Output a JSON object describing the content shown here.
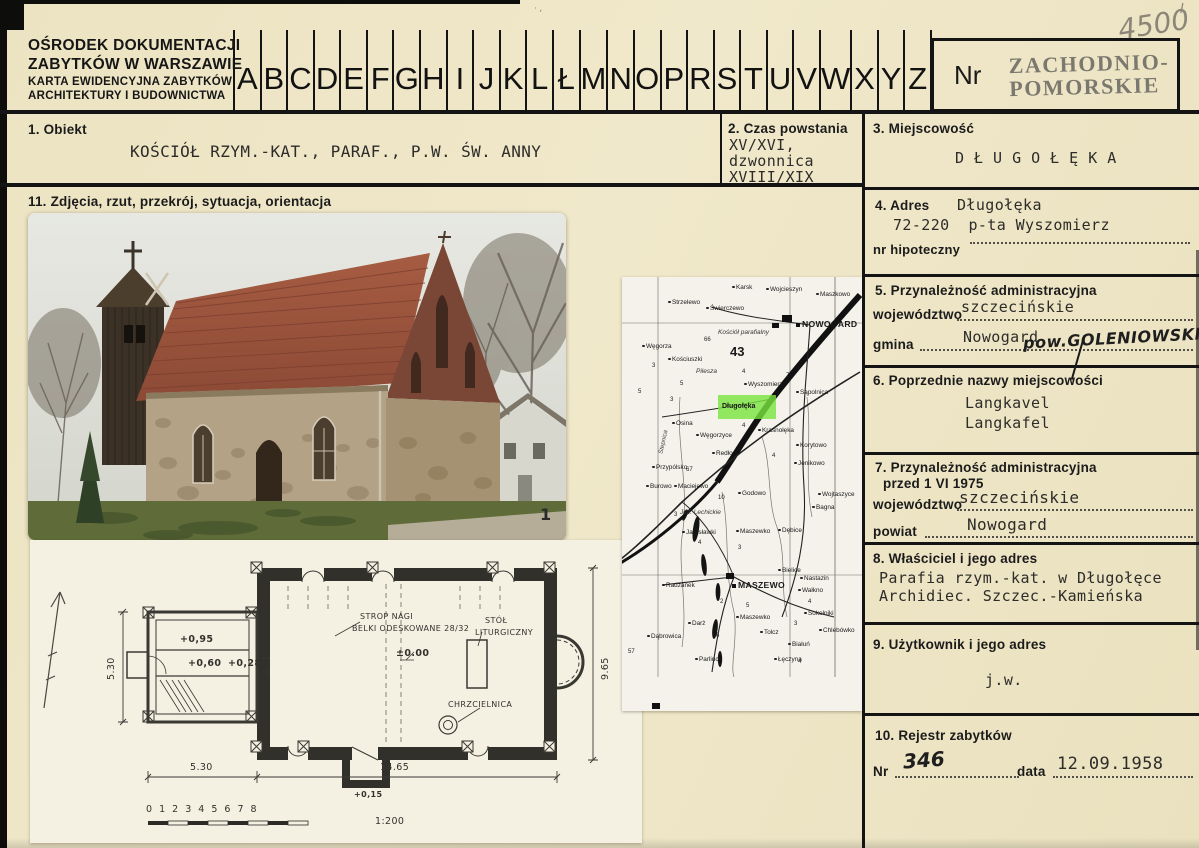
{
  "header": {
    "org_lines": [
      "OŚRODEK DOKUMENTACJI",
      "ZABYTKÓW W WARSZAWIE",
      "KARTA EWIDENCYJNA ZABYTKÓW",
      "ARCHITEKTURY I BUDOWNICTWA"
    ],
    "alphabet": [
      "A",
      "B",
      "C",
      "D",
      "E",
      "F",
      "G",
      "H",
      "I",
      "J",
      "K",
      "L",
      "Ł",
      "M",
      "N",
      "O",
      "P",
      "R",
      "S",
      "T",
      "U",
      "V",
      "W",
      "X",
      "Y",
      "Z"
    ],
    "nr_label": "Nr",
    "stamp_line1": "ZACHODNIO-",
    "stamp_line2": "POMORSKIE",
    "handwritten_number": "4500",
    "handwritten_mark": "I."
  },
  "fields": {
    "f1": {
      "label": "1. Obiekt",
      "value": "KOŚCIÓŁ RZYM.-KAT., PARAF., P.W. ŚW. ANNY"
    },
    "f2": {
      "label": "2. Czas powstania",
      "line1": "XV/XVI,",
      "line2": "dzwonnica",
      "line3": "XVIII/XIX"
    },
    "f3": {
      "label": "3. Miejscowość",
      "value": "DŁUGOŁĘKA"
    },
    "f4": {
      "label": "4. Adres",
      "line1": "Długołęka",
      "line2": "72-220  p-ta Wyszomierz",
      "sub_label": "nr hipoteczny"
    },
    "f5": {
      "label": "5. Przynależność administracyjna",
      "row1_label": "województwo",
      "row1_value": "szczecińskie",
      "row2_label": "gmina",
      "row2_value": "Nowogard",
      "row2_handwritten": "pow.GOLENIOWSKI"
    },
    "f6": {
      "label": "6. Poprzednie nazwy miejscowości",
      "line1": "Langkavel",
      "line2": "Langkafel"
    },
    "f7": {
      "label": "7. Przynależność administracyjna",
      "label2": "przed 1 VI 1975",
      "row1_label": "województwo",
      "row1_value": "szczecińskie",
      "row2_label": "powiat",
      "row2_value": "Nowogard"
    },
    "f8": {
      "label": "8. Właściciel i jego adres",
      "line1": "Parafia rzym.-kat. w Długołęce",
      "line2": "Archidiec. Szczec.-Kamieńska"
    },
    "f9": {
      "label": "9. Użytkownik i jego adres",
      "value": "j.w."
    },
    "f10": {
      "label": "10. Rejestr zabytków",
      "nr_label": "Nr",
      "nr_value": "346",
      "date_label": "data",
      "date_value": "12.09.1958"
    },
    "f11": {
      "label": "11. Zdjęcia, rzut, przekrój, sytuacja, orientacja"
    }
  },
  "photo": {
    "mark": "1"
  },
  "plan": {
    "dim_left": "5.30",
    "level_top": "+0,95",
    "level_mid": "+0,60",
    "level_low": "+0,28",
    "strop_line1": "STROP NAGI",
    "strop_line2": "BELKI ODESKOWANE 28/32",
    "zero_level": "±0.00",
    "stol_line1": "STÓŁ",
    "stol_line2": "LITURGICZNY",
    "chrzcielnica": "CHRZCIELNICA",
    "level_porch": "+0,15",
    "dim_bottom_left": "5.30",
    "dim_bottom_right": "14.65",
    "dim_right": "9.65",
    "scale_numbers": "0   1   2   3   4   5   6   7   8",
    "scale_ratio": "1:200"
  },
  "map": {
    "highlight_name": "Długołęka",
    "labels": [
      {
        "t": "Karsk",
        "x": 110,
        "y": 8,
        "k": "s"
      },
      {
        "t": "Wojcieszyn",
        "x": 144,
        "y": 10,
        "k": "s"
      },
      {
        "t": "Maszkowo",
        "x": 194,
        "y": 15,
        "k": "s"
      },
      {
        "t": "Strzelewo",
        "x": 46,
        "y": 23,
        "k": "s"
      },
      {
        "t": "Świerczewo",
        "x": 84,
        "y": 29,
        "k": "s"
      },
      {
        "t": "NOWOGARD",
        "x": 174,
        "y": 43,
        "k": "b"
      },
      {
        "t": "Kościół parafialny",
        "x": 96,
        "y": 53,
        "k": "i"
      },
      {
        "t": "66",
        "x": 82,
        "y": 60,
        "k": "n"
      },
      {
        "t": "43",
        "x": 108,
        "y": 68,
        "k": "N"
      },
      {
        "t": "Węgorza",
        "x": 20,
        "y": 67,
        "k": "s"
      },
      {
        "t": "Kościuszki",
        "x": 46,
        "y": 80,
        "k": "s"
      },
      {
        "t": "Pilesza",
        "x": 74,
        "y": 92,
        "k": "i"
      },
      {
        "t": "Wyszomierz",
        "x": 122,
        "y": 105,
        "k": "s"
      },
      {
        "t": "Sąpolnica",
        "x": 174,
        "y": 113,
        "k": "s"
      },
      {
        "t": "Osina",
        "x": 50,
        "y": 144,
        "k": "s"
      },
      {
        "t": "Węgorzyce",
        "x": 74,
        "y": 156,
        "k": "s"
      },
      {
        "t": "Krasnołęka",
        "x": 136,
        "y": 151,
        "k": "s"
      },
      {
        "t": "Korytowo",
        "x": 174,
        "y": 166,
        "k": "s"
      },
      {
        "t": "Redło",
        "x": 90,
        "y": 174,
        "k": "s"
      },
      {
        "t": "Jenikowo",
        "x": 172,
        "y": 184,
        "k": "s"
      },
      {
        "t": "Przypólsko",
        "x": 30,
        "y": 188,
        "k": "s"
      },
      {
        "t": "Burowo",
        "x": 24,
        "y": 207,
        "k": "s"
      },
      {
        "t": "Maciejewo",
        "x": 52,
        "y": 207,
        "k": "s"
      },
      {
        "t": "Godowo",
        "x": 116,
        "y": 214,
        "k": "s"
      },
      {
        "t": "Wojtaszyce",
        "x": 196,
        "y": 215,
        "k": "s"
      },
      {
        "t": "Bagna",
        "x": 190,
        "y": 228,
        "k": "s"
      },
      {
        "t": "Jez. Lechickie",
        "x": 58,
        "y": 233,
        "k": "i"
      },
      {
        "t": "10",
        "x": 96,
        "y": 218,
        "k": "n"
      },
      {
        "t": "Jarosławki",
        "x": 60,
        "y": 253,
        "k": "s"
      },
      {
        "t": "Maszewko",
        "x": 114,
        "y": 252,
        "k": "s"
      },
      {
        "t": "Dębice",
        "x": 156,
        "y": 251,
        "k": "s"
      },
      {
        "t": "Bielice",
        "x": 156,
        "y": 291,
        "k": "s"
      },
      {
        "t": "Nastazin",
        "x": 178,
        "y": 299,
        "k": "s"
      },
      {
        "t": "Radzanek",
        "x": 40,
        "y": 306,
        "k": "s"
      },
      {
        "t": "MASZEWO",
        "x": 110,
        "y": 304,
        "k": "b"
      },
      {
        "t": "Wałkno",
        "x": 176,
        "y": 311,
        "k": "s"
      },
      {
        "t": "Darż",
        "x": 66,
        "y": 344,
        "k": "s"
      },
      {
        "t": "Maszewko",
        "x": 114,
        "y": 338,
        "k": "s"
      },
      {
        "t": "Sokolniki",
        "x": 182,
        "y": 334,
        "k": "s"
      },
      {
        "t": "Tolcz",
        "x": 138,
        "y": 353,
        "k": "s"
      },
      {
        "t": "Chlebówko",
        "x": 197,
        "y": 351,
        "k": "s"
      },
      {
        "t": "Dąbrowica",
        "x": 25,
        "y": 357,
        "k": "s"
      },
      {
        "t": "Białuń",
        "x": 166,
        "y": 365,
        "k": "s"
      },
      {
        "t": "Parlino",
        "x": 73,
        "y": 380,
        "k": "s"
      },
      {
        "t": "Łęczyna",
        "x": 152,
        "y": 380,
        "k": "s"
      },
      {
        "t": "Stepnica",
        "x": 30,
        "y": 162,
        "k": "v"
      },
      {
        "t": "5",
        "x": 16,
        "y": 112,
        "k": "n"
      },
      {
        "t": "3",
        "x": 30,
        "y": 86,
        "k": "n"
      },
      {
        "t": "4",
        "x": 120,
        "y": 92,
        "k": "n"
      },
      {
        "t": "7",
        "x": 164,
        "y": 96,
        "k": "n"
      },
      {
        "t": "4",
        "x": 120,
        "y": 146,
        "k": "n"
      },
      {
        "t": "5",
        "x": 58,
        "y": 104,
        "k": "n"
      },
      {
        "t": "3",
        "x": 48,
        "y": 120,
        "k": "n"
      },
      {
        "t": "4",
        "x": 150,
        "y": 176,
        "k": "n"
      },
      {
        "t": "57",
        "x": 6,
        "y": 372,
        "k": "n"
      },
      {
        "t": "67",
        "x": 64,
        "y": 190,
        "k": "n"
      },
      {
        "t": "3",
        "x": 52,
        "y": 235,
        "k": "n"
      },
      {
        "t": "4",
        "x": 76,
        "y": 263,
        "k": "n"
      },
      {
        "t": "3",
        "x": 116,
        "y": 268,
        "k": "n"
      },
      {
        "t": "5",
        "x": 124,
        "y": 326,
        "k": "n"
      },
      {
        "t": "2",
        "x": 98,
        "y": 322,
        "k": "n"
      },
      {
        "t": "4",
        "x": 186,
        "y": 322,
        "k": "n"
      },
      {
        "t": "3",
        "x": 172,
        "y": 344,
        "k": "n"
      },
      {
        "t": "4",
        "x": 176,
        "y": 382,
        "k": "n"
      },
      {
        "t": "6",
        "x": 94,
        "y": 356,
        "k": "n"
      }
    ]
  },
  "colors": {
    "card_bg": "#ece3c2",
    "ink": "#1c1c1c",
    "stamp_ink": "#716f68",
    "highlight_green": "#79e33f",
    "pencil": "#8d8678"
  }
}
